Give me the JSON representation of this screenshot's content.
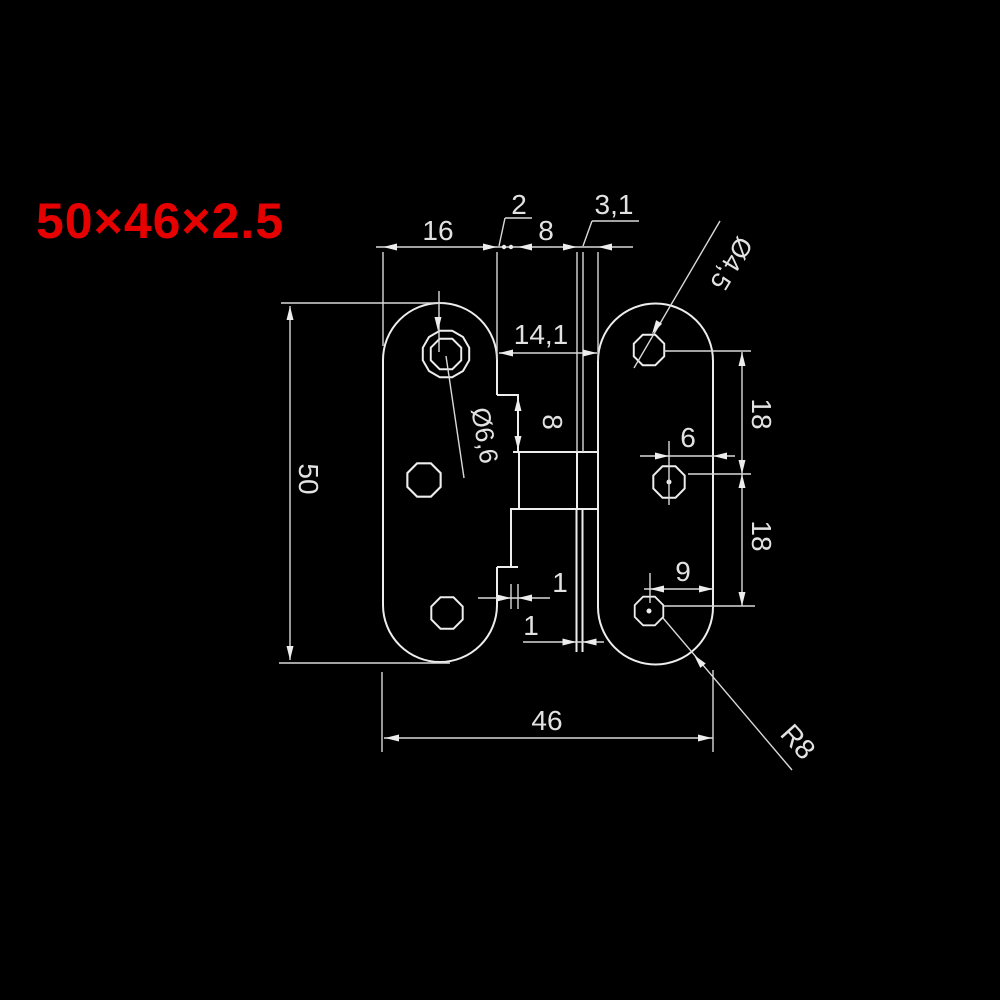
{
  "title": {
    "text": "50×46×2.5",
    "color": "#e60000"
  },
  "diagram": {
    "type": "engineering-drawing",
    "part": "hinge-plate",
    "colors": {
      "background": "#000000",
      "line": "#ededed",
      "dim_text": "#e2e2e2"
    },
    "labels": {
      "left_plate_width": "16",
      "top_gap": "2",
      "knuckle_width": "8",
      "top_right_gap": "3,1",
      "plates_gap": "14,1",
      "knuckle_step_height": "8",
      "plate_height": "50",
      "top_right_hole_dia": "Ø4,5",
      "top_left_hole_dia": "Ø6,6",
      "right_hole_spacing_upper": "18",
      "right_hole_spacing_lower": "18",
      "mid_hole_edge_offset": "6",
      "bottom_hole_edge_offset": "9",
      "pin_gap_left": "1",
      "pin_gap_right": "1",
      "overall_width": "46",
      "end_radius": "R8"
    }
  }
}
